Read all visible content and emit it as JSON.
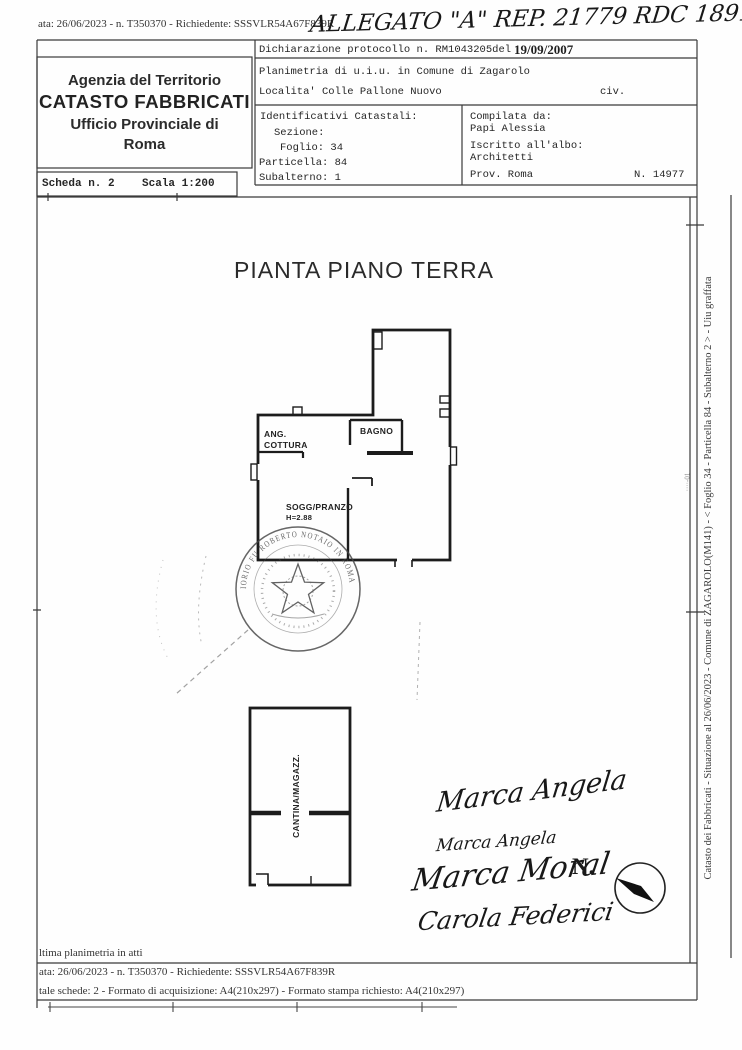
{
  "top": {
    "meta_line": "ata: 26/06/2023 - n. T350370 - Richiedente: SSSVLR54A67F839R",
    "handwriting": "ALLEGATO \"A\" REP. 21779 RDC 1891"
  },
  "header": {
    "agency": {
      "line1": "Agenzia del Territorio",
      "line2": "CATASTO FABBRICATI",
      "line3": "Ufficio Provinciale di",
      "line4": "Roma"
    },
    "declaration": {
      "label": "Dichiarazione protocollo n. RM1043205del",
      "date": "19/09/2007"
    },
    "planimetria": "Planimetria di u.i.u. in Comune di Zagarolo",
    "localita": "Localita' Colle Pallone Nuovo",
    "civ": "civ.",
    "identificativi": {
      "title": "Identificativi Catastali:",
      "sezione": "Sezione:",
      "foglio": "Foglio: 34",
      "particella": "Particella: 84",
      "subalterno": "Subalterno: 1"
    },
    "compilata": {
      "label": "Compilata da:",
      "name": "Papi Alessia",
      "albo_label": "Iscritto all'albo:",
      "albo": "Architetti",
      "prov": "Prov. Roma",
      "num": "N. 14977"
    },
    "scheda": "Scheda n. 2",
    "scala": "Scala 1:200"
  },
  "drawing": {
    "title": "PIANTA PIANO TERRA",
    "rooms": {
      "bagno": "BAGNO",
      "cottura1": "ANG.",
      "cottura2": "COTTURA",
      "soggiorno": "SOGG/PRANZO",
      "soggiorno_h": "H=2.88",
      "cantina": "CANTINA/MAGAZZ."
    },
    "stamp_text": "IORIO FU ROBERTO NOTAIO IN ROMA",
    "north_label": "N.",
    "signatures": [
      "Marca Angela",
      "Marca Angela",
      "Marca Moral",
      "Carola Federici"
    ]
  },
  "side": {
    "caption": "Catasto dei Fabbricati - Situazione al 26/06/2023 - Comune di ZAGAROLO(M141) - < Foglio 34 - Particella  84 - Subalterno 2 > - Uiu graffata",
    "edge_code": "····-01"
  },
  "footer": {
    "line1": "ltima planimetria in atti",
    "line2": "ata: 26/06/2023 - n. T350370 - Richiedente: SSSVLR54A67F839R",
    "line3": "tale schede: 2 - Formato di acquisizione: A4(210x297)  - Formato stampa richiesto: A4(210x297)"
  },
  "colors": {
    "ink": "#1c1c1c",
    "frame": "#3a3a3a",
    "paper": "#fefefe"
  }
}
